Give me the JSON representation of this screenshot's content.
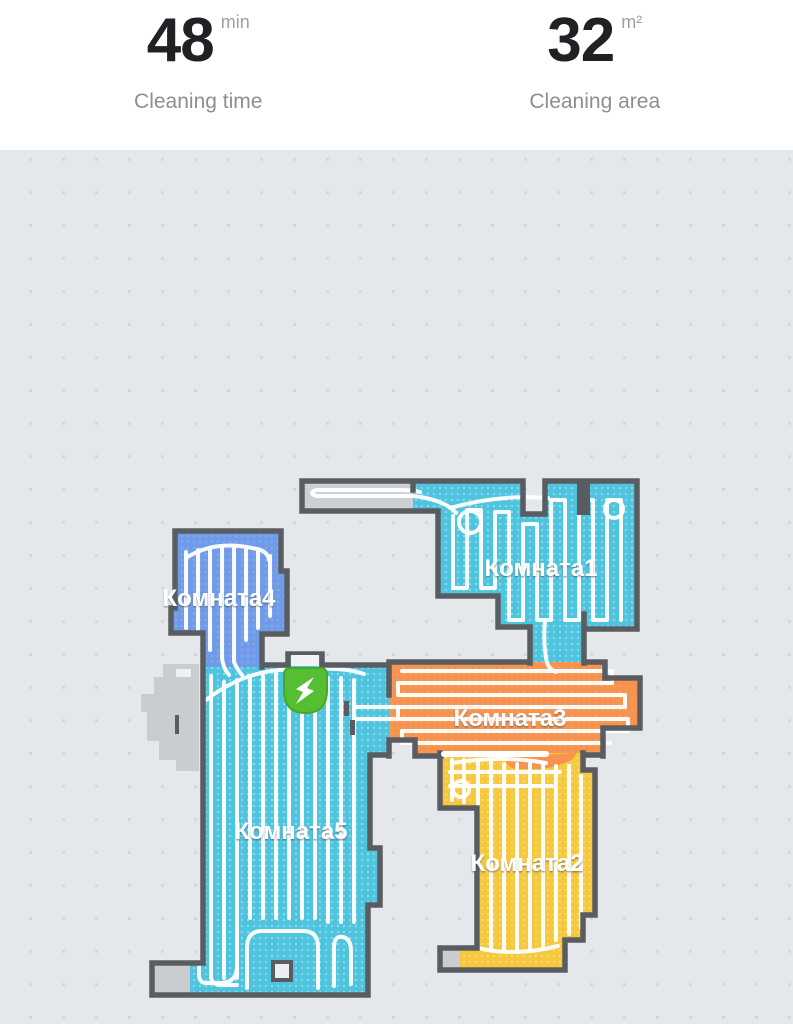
{
  "header": {
    "stats": [
      {
        "value": "48",
        "unit": "min",
        "label": "Cleaning time"
      },
      {
        "value": "32",
        "unit": "m²",
        "label": "Cleaning area"
      }
    ]
  },
  "map": {
    "rooms": [
      {
        "name": "Комната1",
        "color": "#4EC4DE"
      },
      {
        "name": "Комната2",
        "color": "#F6C83E"
      },
      {
        "name": "Комната3",
        "color": "#F6934E"
      },
      {
        "name": "Комната4",
        "color": "#6F9BE9"
      },
      {
        "name": "Комната5",
        "color": "#4EC4DE"
      }
    ],
    "dock": {
      "name": "charging-dock",
      "color": "#55BE32",
      "bolt_color": "#FFFFFF"
    },
    "palette": {
      "wall": "#595D62",
      "background": "#E5E8EB",
      "unknown_area": "#CACDCF",
      "corridor_unknown": "#CDD0D3",
      "cleaning_path": "#FFFFFF"
    }
  }
}
